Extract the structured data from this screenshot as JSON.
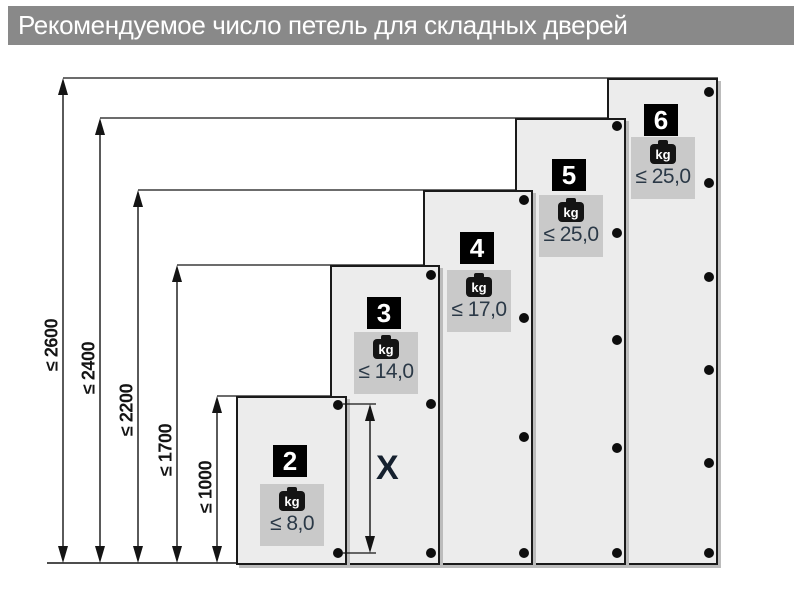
{
  "title": {
    "text": "Рекомендуемое число петель для складных дверей"
  },
  "colors": {
    "header_bg": "#898989",
    "header_text": "#ffffff",
    "door_fill": "#ececec",
    "door_border": "#1a1a1a",
    "door_shadow": "#bcbcbc",
    "badge_bg": "#000000",
    "badge_text": "#ffffff",
    "kg_box_bg": "#c9c9c9",
    "kg_icon_bg": "#141414",
    "kg_icon_text": "#ffffff",
    "weight_text": "#2b3947",
    "dim_text": "#141414",
    "line": "#141414"
  },
  "kg_unit": "kg",
  "baseline": {
    "y": 563,
    "x1": 47,
    "x2": 718
  },
  "dimensions": [
    {
      "label": "≤ 2600",
      "x": 63,
      "top": 78,
      "ext_x2": 718,
      "label_cy": 345
    },
    {
      "label": "≤ 2400",
      "x": 100,
      "top": 118,
      "ext_x2": 626,
      "label_cy": 368
    },
    {
      "label": "≤ 2200",
      "x": 138,
      "top": 190,
      "ext_x2": 533,
      "label_cy": 410
    },
    {
      "label": "≤ 1700",
      "x": 177,
      "top": 265,
      "ext_x2": 440,
      "label_cy": 450
    },
    {
      "label": "≤ 1000",
      "x": 217,
      "top": 396,
      "ext_x2": 347,
      "label_cy": 487
    }
  ],
  "doors": [
    {
      "number": "2",
      "hinge_count": 2,
      "weight": "≤ 8,0",
      "height_limit": "≤ 1000",
      "x": 236,
      "top": 396,
      "width": 111,
      "badge_top": 47,
      "kg_top": 86,
      "hinges_y": [
        405,
        553
      ]
    },
    {
      "number": "3",
      "hinge_count": 3,
      "weight": "≤ 14,0",
      "height_limit": "≤ 1700",
      "x": 330,
      "top": 265,
      "width": 110,
      "badge_top": 30,
      "kg_top": 65,
      "hinges_y": [
        275,
        404,
        553
      ]
    },
    {
      "number": "4",
      "hinge_count": 4,
      "weight": "≤ 17,0",
      "height_limit": "≤ 2200",
      "x": 423,
      "top": 190,
      "width": 110,
      "badge_top": 40,
      "kg_top": 78,
      "hinges_y": [
        200,
        318,
        437,
        553
      ]
    },
    {
      "number": "5",
      "hinge_count": 5,
      "weight": "≤ 25,0",
      "height_limit": "≤ 2400",
      "x": 515,
      "top": 118,
      "width": 111,
      "badge_top": 39,
      "kg_top": 75,
      "hinges_y": [
        126,
        233,
        340,
        448,
        553
      ]
    },
    {
      "number": "6",
      "hinge_count": 6,
      "weight": "≤ 25,0",
      "height_limit": "≤ 2600",
      "x": 607,
      "top": 78,
      "width": 111,
      "badge_top": 24,
      "kg_top": 57,
      "hinges_y": [
        92,
        183,
        277,
        370,
        463,
        553
      ]
    }
  ],
  "x_dimension": {
    "label": "X",
    "x": 370,
    "y1": 404,
    "y2": 553,
    "ref_x1": 343,
    "ref_x2": 376,
    "label_x": 376,
    "label_y": 468
  }
}
